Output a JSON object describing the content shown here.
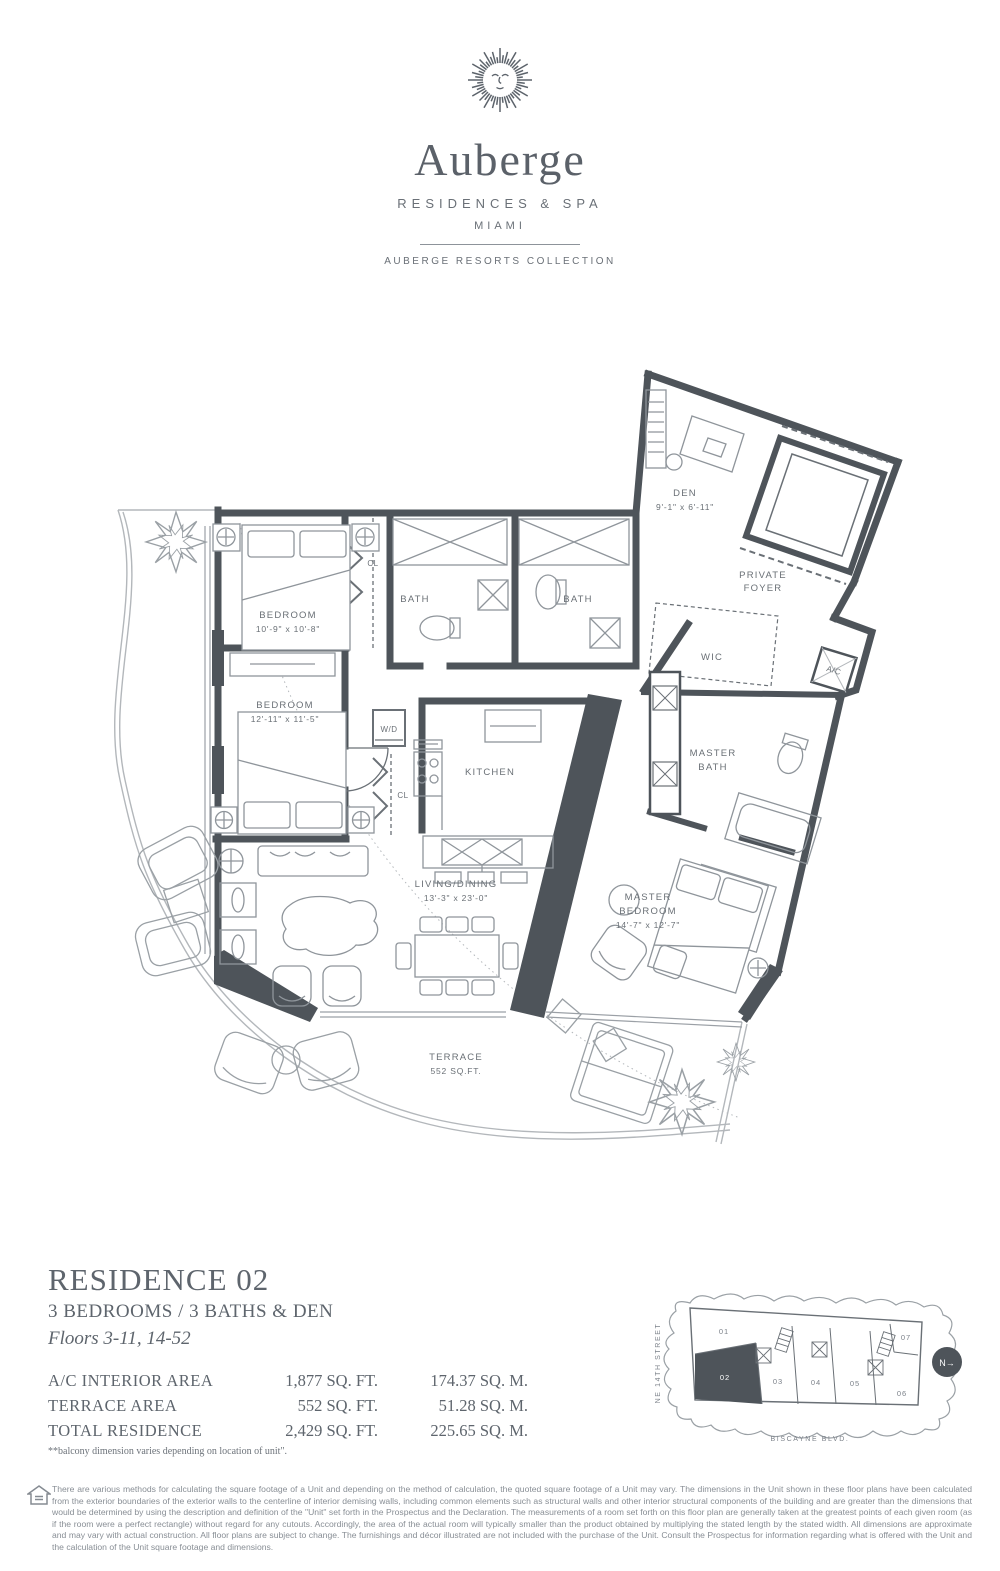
{
  "colors": {
    "text": "#5d646c",
    "wall": "#4e545a",
    "furniture": "#8f959b",
    "light_line": "#b3b7bb"
  },
  "header": {
    "brand": "Auberge",
    "subtitle": "RESIDENCES & SPA",
    "city": "MIAMI",
    "collection": "AUBERGE RESORTS COLLECTION",
    "logo_icon": "sun-face-icon"
  },
  "floorplan": {
    "den_name": "DEN",
    "den_dims": "9'-1\" x 6'-11\"",
    "foyer_line1": "PRIVATE",
    "foyer_line2": "FOYER",
    "bedroom1_name": "BEDROOM",
    "bedroom1_dims": "10'-9\" x 10'-8\"",
    "bath1": "BATH",
    "bath2": "BATH",
    "cl1": "CL",
    "cl2": "CL",
    "wd": "W/D",
    "bedroom2_name": "BEDROOM",
    "bedroom2_dims": "12'-11\" x 11'-5\"",
    "kitchen": "KITCHEN",
    "wic": "WIC",
    "ac": "A/C",
    "masterbath_line1": "MASTER",
    "masterbath_line2": "BATH",
    "living_name": "LIVING/DINING",
    "living_dims": "13'-3\" x 23'-0\"",
    "master_line1": "MASTER",
    "master_line2": "BEDROOM",
    "master_dims": "14'-7\" x 12'-7\"",
    "terrace_name": "TERRACE",
    "terrace_area": "552 SQ.FT."
  },
  "residence": {
    "title": "RESIDENCE 02",
    "subtitle": "3 BEDROOMS / 3 BATHS & DEN",
    "floors": "Floors 3-11, 14-52",
    "areas": [
      {
        "label": "A/C INTERIOR AREA",
        "sqft": "1,877 SQ. FT.",
        "sqm": "174.37 SQ. M."
      },
      {
        "label": "TERRACE AREA",
        "sqft": "552 SQ. FT.",
        "sqm": "51.28 SQ. M."
      },
      {
        "label": "TOTAL RESIDENCE",
        "sqft": "2,429 SQ. FT.",
        "sqm": "225.65 SQ. M."
      }
    ],
    "footnote": "**balcony dimension varies depending on location of unit\"."
  },
  "keyplan": {
    "street_left": "NE 14TH STREET",
    "street_bottom": "BISCAYNE BLVD.",
    "north": "N→",
    "units": [
      "01",
      "02",
      "03",
      "04",
      "05",
      "06",
      "07"
    ],
    "highlighted_unit": "02"
  },
  "disclaimer": {
    "icon": "equal-housing-icon",
    "text": "There are various methods for calculating the square footage of a Unit and depending on the method of calculation, the quoted square footage of a Unit may vary.  The dimensions in the Unit shown in these floor plans have been calculated from the exterior boundaries of the exterior walls to the centerline of interior demising walls, including common elements such as structural walls and other interior structural components of the building and are greater than the dimensions that would be determined by using the description and definition of the \"Unit\" set forth in the Prospectus and the Declaration.  The measurements of a room set forth on this floor plan are generally taken at the greatest points of each given room (as if the room were a perfect rectangle) without regard for any cutouts.  Accordingly, the area of the actual room will typically smaller than the product obtained by multiplying the stated length by the stated width.  All dimensions are approximate and may vary with actual construction. All floor plans are subject to change.  The furnishings and décor illustrated are not included with the purchase of the Unit.  Consult the Prospectus for information regarding what is offered with the Unit and the calculation of the Unit square footage and dimensions."
  }
}
